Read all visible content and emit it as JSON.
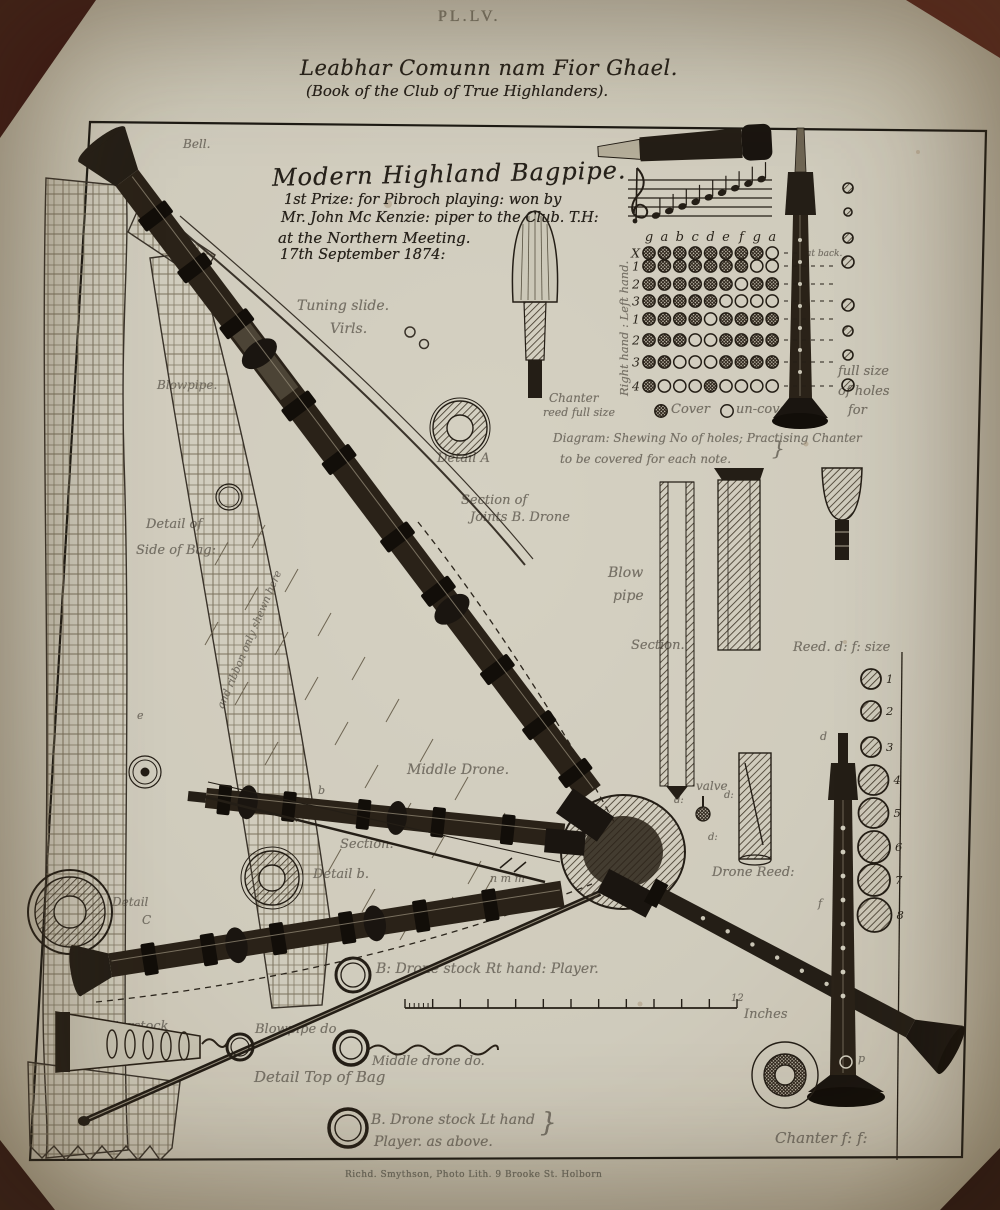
{
  "page": {
    "plate_number": "PL.LV.",
    "title_gaelic": "Leabhar Comunn nam Fior Ghael.",
    "title_english": "(Book of the Club of True Highlanders).",
    "imprint": "Richd. Smythson, Photo Lith. 9 Brooke St. Holborn"
  },
  "heading": {
    "title": "Modern Highland Bagpipe.",
    "line1": "1st Prize: for Pibroch playing: won by",
    "line2": "Mr. John Mc Kenzie: piper to the Club. T.H:",
    "line3": "at the Northern Meeting.",
    "line4": "17th September 1874:"
  },
  "fingering_chart": {
    "note_letters": [
      "g",
      "a",
      "b",
      "c",
      "d",
      "e",
      "f",
      "g",
      "a"
    ],
    "rows": [
      {
        "hand": "left",
        "label": "X",
        "holes": [
          1,
          1,
          1,
          1,
          1,
          1,
          1,
          1,
          0
        ],
        "note": "at back."
      },
      {
        "hand": "left",
        "label": "1",
        "holes": [
          1,
          1,
          1,
          1,
          1,
          1,
          1,
          0,
          0
        ]
      },
      {
        "hand": "left",
        "label": "2",
        "holes": [
          1,
          1,
          1,
          1,
          1,
          1,
          0,
          1,
          1
        ]
      },
      {
        "hand": "left",
        "label": "3",
        "holes": [
          1,
          1,
          1,
          1,
          1,
          0,
          0,
          0,
          0
        ]
      },
      {
        "hand": "right",
        "label": "1",
        "holes": [
          1,
          1,
          1,
          1,
          0,
          1,
          1,
          1,
          1
        ]
      },
      {
        "hand": "right",
        "label": "2",
        "holes": [
          1,
          1,
          1,
          0,
          0,
          1,
          1,
          1,
          1
        ]
      },
      {
        "hand": "right",
        "label": "3",
        "holes": [
          1,
          1,
          0,
          0,
          0,
          1,
          1,
          1,
          1
        ]
      },
      {
        "hand": "right",
        "label": "4",
        "holes": [
          1,
          0,
          0,
          0,
          1,
          0,
          0,
          0,
          0
        ]
      }
    ]
  },
  "staff": {
    "clef": "treble",
    "notes": [
      "g",
      "a",
      "b",
      "c",
      "d",
      "e",
      "f",
      "g",
      "a"
    ]
  },
  "reed_sizes": {
    "items": [
      {
        "n": "1",
        "y": 679,
        "r": 10
      },
      {
        "n": "2",
        "y": 711,
        "r": 10
      },
      {
        "n": "3",
        "y": 747,
        "r": 10
      },
      {
        "n": "4",
        "y": 780,
        "r": 15
      },
      {
        "n": "5",
        "y": 813,
        "r": 15
      },
      {
        "n": "6",
        "y": 847,
        "r": 16
      },
      {
        "n": "7",
        "y": 880,
        "r": 16
      },
      {
        "n": "8",
        "y": 915,
        "r": 17
      }
    ]
  },
  "fullsize_holes": {
    "items": [
      {
        "y": 188,
        "r": 5
      },
      {
        "y": 212,
        "r": 4
      },
      {
        "y": 238,
        "r": 5
      },
      {
        "y": 262,
        "r": 6
      },
      {
        "y": 305,
        "r": 6
      },
      {
        "y": 331,
        "r": 5
      },
      {
        "y": 355,
        "r": 5
      },
      {
        "y": 385,
        "r": 6
      }
    ]
  },
  "labels": [
    {
      "name": "bell",
      "text": "Bell.",
      "x": 183,
      "y": 138,
      "fs": 12
    },
    {
      "name": "tuning-slide",
      "text": "Tuning slide.",
      "x": 297,
      "y": 299,
      "fs": 14
    },
    {
      "name": "virls",
      "text": "Virls.",
      "x": 330,
      "y": 322,
      "fs": 14
    },
    {
      "name": "blowpipe",
      "text": "Blowpipe.",
      "x": 157,
      "y": 379,
      "fs": 12
    },
    {
      "name": "detail-a",
      "text": "Detail A",
      "x": 437,
      "y": 452,
      "fs": 13
    },
    {
      "name": "section-of-joints-1",
      "text": "Section of",
      "x": 461,
      "y": 494,
      "fs": 13
    },
    {
      "name": "section-of-joints-2",
      "text": "Joints B. Drone",
      "x": 470,
      "y": 511,
      "fs": 13
    },
    {
      "name": "detail-of-side-1",
      "text": "Detail of",
      "x": 146,
      "y": 518,
      "fs": 13
    },
    {
      "name": "detail-of-side-2",
      "text": "Side of Bag:",
      "x": 136,
      "y": 544,
      "fs": 13
    },
    {
      "name": "ribbon-note",
      "text": "and ribbon only shewn here",
      "x": 216,
      "y": 706,
      "fs": 10.5,
      "rot": -67
    },
    {
      "name": "hands-label",
      "text": "Right hand : Left hand.",
      "x": 618,
      "y": 396,
      "fs": 11.5,
      "rot": -90
    },
    {
      "name": "at-back",
      "text": "at back.",
      "x": 806,
      "y": 250,
      "fs": 9
    },
    {
      "name": "chanter-reed-1",
      "text": "Chanter",
      "x": 549,
      "y": 392,
      "fs": 12
    },
    {
      "name": "chanter-reed-2",
      "text": "reed full size",
      "x": 543,
      "y": 407,
      "fs": 11
    },
    {
      "name": "legend-cover",
      "text": "Cover",
      "x": 671,
      "y": 403,
      "fs": 13
    },
    {
      "name": "legend-uncover",
      "text": "un-cover.",
      "x": 736,
      "y": 403,
      "fs": 13
    },
    {
      "name": "full-size-1",
      "text": "full size",
      "x": 838,
      "y": 365,
      "fs": 13
    },
    {
      "name": "full-size-2",
      "text": "of holes",
      "x": 838,
      "y": 385,
      "fs": 13
    },
    {
      "name": "full-size-3",
      "text": "for",
      "x": 848,
      "y": 404,
      "fs": 13
    },
    {
      "name": "diagram-caption-1",
      "text": "Diagram: Shewing No of holes; Practising Chanter",
      "x": 553,
      "y": 432,
      "fs": 12
    },
    {
      "name": "diagram-caption-2",
      "text": "to be covered for each note.",
      "x": 560,
      "y": 453,
      "fs": 12
    },
    {
      "name": "caption-brace",
      "text": "}",
      "x": 772,
      "y": 438,
      "fs": 20
    },
    {
      "name": "blow-pipe-1",
      "text": "Blow",
      "x": 608,
      "y": 566,
      "fs": 14
    },
    {
      "name": "blow-pipe-2",
      "text": "pipe",
      "x": 613,
      "y": 589,
      "fs": 14
    },
    {
      "name": "section-vertical",
      "text": "Section.",
      "x": 631,
      "y": 639,
      "fs": 13
    },
    {
      "name": "reed-size-title",
      "text": "Reed. d: f: size",
      "x": 793,
      "y": 641,
      "fs": 13
    },
    {
      "name": "middle-drone",
      "text": "Middle Drone.",
      "x": 407,
      "y": 763,
      "fs": 14
    },
    {
      "name": "section-rod",
      "text": "Section.",
      "x": 340,
      "y": 838,
      "fs": 13
    },
    {
      "name": "detail-b",
      "text": "Detail b.",
      "x": 313,
      "y": 868,
      "fs": 13
    },
    {
      "name": "letters-nmm",
      "text": "n m m",
      "x": 490,
      "y": 873,
      "fs": 11
    },
    {
      "name": "valve",
      "text": "valve",
      "x": 696,
      "y": 780,
      "fs": 12
    },
    {
      "name": "valve-d1",
      "text": "d:",
      "x": 674,
      "y": 796,
      "fs": 10
    },
    {
      "name": "valve-d2",
      "text": "d:",
      "x": 724,
      "y": 791,
      "fs": 10
    },
    {
      "name": "valve-d3",
      "text": "d:",
      "x": 708,
      "y": 833,
      "fs": 10
    },
    {
      "name": "drone-reed",
      "text": "Drone Reed:",
      "x": 712,
      "y": 866,
      "fs": 13
    },
    {
      "name": "detail-c-1",
      "text": "Detail",
      "x": 112,
      "y": 896,
      "fs": 12
    },
    {
      "name": "detail-c-2",
      "text": "C",
      "x": 142,
      "y": 914,
      "fs": 12
    },
    {
      "name": "letter-e-1",
      "text": "e",
      "x": 137,
      "y": 710,
      "fs": 11
    },
    {
      "name": "letter-e-2",
      "text": "e",
      "x": 101,
      "y": 964,
      "fs": 11
    },
    {
      "name": "letter-a",
      "text": "a",
      "x": 366,
      "y": 510,
      "fs": 11
    },
    {
      "name": "letter-b",
      "text": "b",
      "x": 318,
      "y": 785,
      "fs": 11
    },
    {
      "name": "letter-d",
      "text": "d",
      "x": 820,
      "y": 731,
      "fs": 11
    },
    {
      "name": "letter-f",
      "text": "f",
      "x": 818,
      "y": 898,
      "fs": 11
    },
    {
      "name": "letter-p",
      "text": "p",
      "x": 858,
      "y": 1053,
      "fs": 11
    },
    {
      "name": "drone-stock-rt",
      "text": "B: Drone stock Rt hand: Player.",
      "x": 376,
      "y": 962,
      "fs": 14
    },
    {
      "name": "chanterstock",
      "text": "Chanterstock",
      "x": 80,
      "y": 1020,
      "fs": 13
    },
    {
      "name": "blowpipe-do",
      "text": "Blowpipe do",
      "x": 255,
      "y": 1023,
      "fs": 13
    },
    {
      "name": "middle-drone-do",
      "text": "Middle drone do.",
      "x": 372,
      "y": 1055,
      "fs": 13
    },
    {
      "name": "detail-top-of-bag",
      "text": "Detail Top of Bag",
      "x": 254,
      "y": 1070,
      "fs": 15
    },
    {
      "name": "drone-stock-lt-1",
      "text": "B. Drone stock Lt hand",
      "x": 371,
      "y": 1113,
      "fs": 14
    },
    {
      "name": "drone-stock-lt-2",
      "text": "Player. as above.",
      "x": 374,
      "y": 1135,
      "fs": 14
    },
    {
      "name": "lt-brace",
      "text": "}",
      "x": 540,
      "y": 1110,
      "fs": 26
    },
    {
      "name": "scale-12",
      "text": "12",
      "x": 731,
      "y": 994,
      "fs": 10
    },
    {
      "name": "scale-inches",
      "text": "Inches",
      "x": 744,
      "y": 1008,
      "fs": 13
    },
    {
      "name": "chanter-ff",
      "text": "Chanter f: f:",
      "x": 775,
      "y": 1131,
      "fs": 15
    }
  ]
}
